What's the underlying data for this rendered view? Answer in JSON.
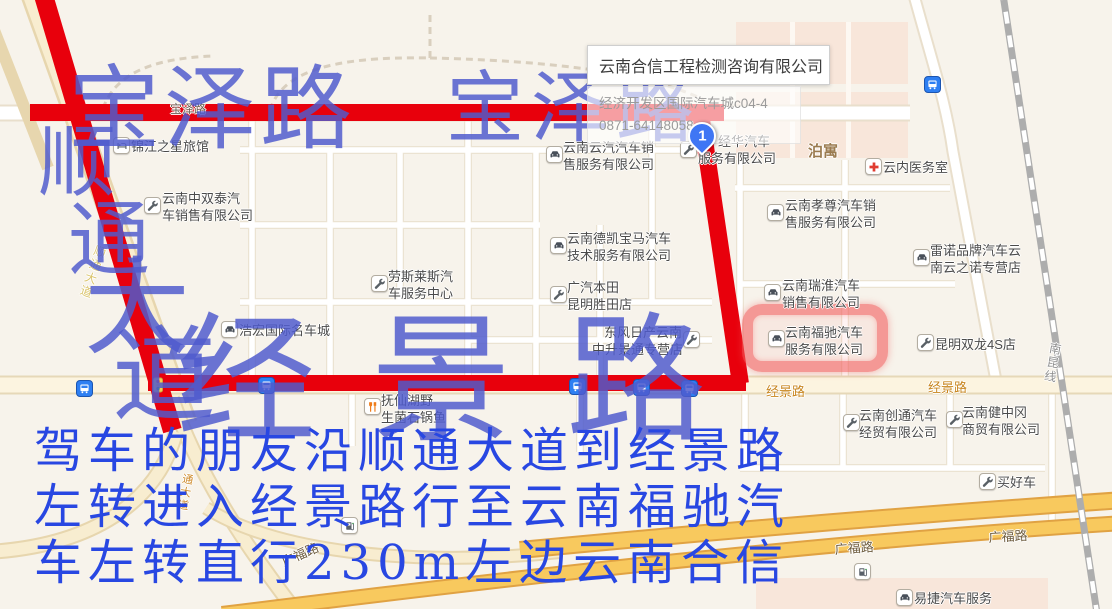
{
  "popup": {
    "title": "云南合信工程检测咨询有限公司",
    "address": "经济开发区国际汽车城c04-4",
    "phone": "0871-64148058",
    "marker_label": "1"
  },
  "annotations": {
    "big_labels": [
      {
        "text": "宝泽路",
        "x": 68,
        "y": 64,
        "size": 92,
        "spacing": 4
      },
      {
        "text": "宝泽路",
        "x": 446,
        "y": 70,
        "size": 78,
        "spacing": 7
      },
      {
        "text": "经景路",
        "x": 176,
        "y": 312,
        "size": 140,
        "spacing": 55
      }
    ],
    "vertical_label": {
      "text": "顺通大道",
      "chars": [
        {
          "ch": "顺",
          "x": 38,
          "y": 124,
          "size": 78
        },
        {
          "ch": "通",
          "x": 68,
          "y": 200,
          "size": 82
        },
        {
          "ch": "大",
          "x": 84,
          "y": 256,
          "size": 106
        },
        {
          "ch": "道",
          "x": 112,
          "y": 324,
          "size": 104
        }
      ]
    },
    "directions_lines": [
      "驾车的朋友沿顺通大道到经景路",
      "左转进入经景路行至云南福驰汽",
      "车左转直行230m左边云南合信"
    ]
  },
  "map": {
    "road_labels": [
      {
        "text": "宝泽路",
        "x": 170,
        "y": 100,
        "size": 12,
        "color": "#6d6052"
      },
      {
        "text": "经景路",
        "x": 766,
        "y": 381,
        "size": 13,
        "color": "#c8861f"
      },
      {
        "text": "经景路",
        "x": 928,
        "y": 377,
        "size": 13,
        "color": "#c8861f"
      },
      {
        "text": "广福路",
        "x": 834,
        "y": 539,
        "size": 13,
        "color": "#6f5d3f",
        "rot": -4
      },
      {
        "text": "广福路",
        "x": 988,
        "y": 527,
        "size": 13,
        "color": "#6f5d3f",
        "rot": -3
      },
      {
        "text": "广福路",
        "x": 278,
        "y": 553,
        "size": 13,
        "color": "#6f5d3f",
        "rot": -24
      },
      {
        "text": "泊寓",
        "x": 808,
        "y": 140,
        "size": 15,
        "color": "#9b7b4f",
        "bold": true
      },
      {
        "text": "通大道",
        "x": 180,
        "y": 472,
        "size": 11,
        "color": "#cf8c2d",
        "vertical": true,
        "rot": 10
      },
      {
        "text": "顺通大道",
        "x": 94,
        "y": 243,
        "size": 12,
        "color": "#dbc56e",
        "vertical": true,
        "rot": 19
      },
      {
        "text": "南昆线",
        "x": 1048,
        "y": 341,
        "size": 12,
        "color": "#8f8f8f",
        "vertical": true,
        "rot": 10
      }
    ],
    "pois": [
      {
        "id": "jinjiang-hotel",
        "icon": "bed",
        "ix": 113,
        "iy": 137,
        "tx": 131,
        "ty": 138,
        "lines": [
          "锦江之星旅馆"
        ]
      },
      {
        "id": "zhongshuangtai",
        "icon": "wrench",
        "ix": 144,
        "iy": 197,
        "tx": 162,
        "ty": 190,
        "lines": [
          "云南中双泰汽",
          "车销售有限公司"
        ]
      },
      {
        "id": "yunqi",
        "icon": "car",
        "ix": 546,
        "iy": 146,
        "tx": 563,
        "ty": 139,
        "lines": [
          "云南云汽汽车销",
          "售服务有限公司"
        ]
      },
      {
        "id": "jinghua",
        "icon": "wrench",
        "ix": 680,
        "iy": 141,
        "tx": 698,
        "ty": 133,
        "w": 72,
        "align": "right",
        "lines": [
          "经华汽车",
          "服务有限公司"
        ]
      },
      {
        "id": "yunnei-clinic",
        "icon": "cross",
        "ix": 865,
        "iy": 158,
        "tx": 883,
        "ty": 159,
        "lines": [
          "云内医务室"
        ]
      },
      {
        "id": "xiaozun",
        "icon": "car",
        "ix": 767,
        "iy": 204,
        "tx": 785,
        "ty": 197,
        "lines": [
          "云南孝尊汽车销",
          "售服务有限公司"
        ]
      },
      {
        "id": "renault",
        "icon": "car",
        "ix": 913,
        "iy": 249,
        "tx": 930,
        "ty": 242,
        "lines": [
          "雷诺品牌汽车云",
          "南云之诺专营店"
        ]
      },
      {
        "id": "ruihuai",
        "icon": "car",
        "ix": 764,
        "iy": 284,
        "tx": 782,
        "ty": 277,
        "lines": [
          "云南瑞淮汽车",
          "销售有限公司"
        ]
      },
      {
        "id": "dekai-bmw",
        "icon": "car",
        "ix": 550,
        "iy": 237,
        "tx": 567,
        "ty": 230,
        "lines": [
          "云南德凯宝马汽车",
          "技术服务有限公司"
        ]
      },
      {
        "id": "guangqi-honda",
        "icon": "wrench",
        "ix": 550,
        "iy": 286,
        "tx": 567,
        "ty": 279,
        "lines": [
          "广汽本田",
          "昆明胜田店"
        ]
      },
      {
        "id": "rolls-royce",
        "icon": "wrench",
        "ix": 371,
        "iy": 275,
        "tx": 388,
        "ty": 268,
        "lines": [
          "劳斯莱斯汽",
          "车服务中心"
        ]
      },
      {
        "id": "haohong",
        "icon": "car",
        "ix": 221,
        "iy": 321,
        "tx": 239,
        "ty": 322,
        "lines": [
          "浩宏国际名车城"
        ]
      },
      {
        "id": "dongfeng-nissan",
        "icon": "wrench",
        "ix": 683,
        "iy": 331,
        "tx": 592,
        "ty": 324,
        "w": 90,
        "align": "right",
        "lines": [
          "东风日产云南",
          "中升景通专营店"
        ]
      },
      {
        "id": "fuxianhu",
        "icon": "food",
        "ix": 364,
        "iy": 398,
        "tx": 381,
        "ty": 392,
        "lines": [
          "抚仙湖野",
          "生菌石锅鱼"
        ]
      },
      {
        "id": "fuchi",
        "icon": "car",
        "ix": 768,
        "iy": 330,
        "tx": 785,
        "ty": 324,
        "lines": [
          "云南福驰汽车",
          "服务有限公司"
        ]
      },
      {
        "id": "shuanglong-4s",
        "icon": "wrench",
        "ix": 917,
        "iy": 334,
        "tx": 935,
        "ty": 336,
        "lines": [
          "昆明双龙4S店"
        ]
      },
      {
        "id": "chuangtong",
        "icon": "wrench",
        "ix": 843,
        "iy": 414,
        "tx": 859,
        "ty": 407,
        "lines": [
          "云南创通汽车",
          "经贸有限公司"
        ]
      },
      {
        "id": "jianzhonggang",
        "icon": "wrench",
        "ix": 946,
        "iy": 411,
        "tx": 962,
        "ty": 404,
        "lines": [
          "云南健中冈",
          "商贸有限公司"
        ]
      },
      {
        "id": "maihaoche",
        "icon": "wrench",
        "ix": 979,
        "iy": 473,
        "tx": 997,
        "ty": 474,
        "lines": [
          "买好车"
        ]
      },
      {
        "id": "yijie",
        "icon": "car",
        "ix": 896,
        "iy": 589,
        "tx": 914,
        "ty": 590,
        "lines": [
          "易捷汽车服务"
        ]
      }
    ],
    "bus_stops": [
      {
        "x": 76,
        "y": 380
      },
      {
        "x": 258,
        "y": 377
      },
      {
        "x": 569,
        "y": 378
      },
      {
        "x": 633,
        "y": 379
      },
      {
        "x": 681,
        "y": 380
      },
      {
        "x": 924,
        "y": 76
      }
    ],
    "gas_stations": [
      {
        "x": 341,
        "y": 517
      },
      {
        "x": 854,
        "y": 563
      }
    ],
    "traffic_lights": [
      {
        "x": 152,
        "y": 377
      }
    ]
  },
  "colors": {
    "route_red": "#e8000c",
    "annotation_blue": "#4f5bcd",
    "directions_blue": "#2847e2",
    "highlight_red": "rgba(240,85,85,0.55)"
  }
}
